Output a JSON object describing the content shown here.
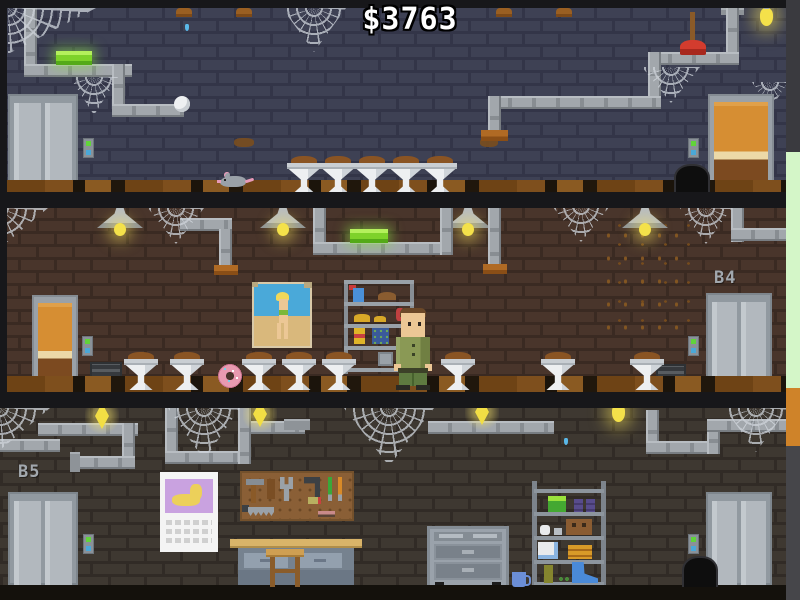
{
  "hud": {
    "money": "$3763"
  },
  "floors": [
    {
      "name": "basement-top-floor",
      "label": "",
      "objects": [
        "elevator-gray-left",
        "wooden-door-right",
        "call-buttons",
        "spider-webs",
        "pipes",
        "green-fluorescent-lamp",
        "hanging-bulb",
        "plunger-on-pipe",
        "spider-egg",
        "leaking-pipe-caps",
        "water-drip",
        "firefly",
        "rat",
        "dirty-sinks",
        "wall-stains",
        "mouse-hole"
      ]
    },
    {
      "name": "basement-floor-b4",
      "label": "B4",
      "objects": [
        "wooden-door-left",
        "elevator-gray-right",
        "call-buttons",
        "ceiling-lamps",
        "pipes",
        "green-fluorescent-lamp",
        "spider-webs",
        "fly-swarm",
        "pinup-poster",
        "supply-shelf",
        "janitor-character",
        "air-vents",
        "dirty-sinks",
        "donut"
      ]
    },
    {
      "name": "basement-floor-b5",
      "label": "B5",
      "objects": [
        "elevator-gray-left",
        "elevator-gray-right",
        "call-buttons",
        "pipes",
        "flame-lights",
        "hanging-bulb",
        "spider-webs",
        "calendar",
        "pegboard-with-tools",
        "workbench",
        "stool",
        "tool-cabinet",
        "mug",
        "storage-shelf",
        "trash-hole",
        "water-drip"
      ]
    }
  ],
  "colors": {
    "money_text": "#ffffff",
    "wall_top_floor": "#3e4154",
    "wall_middle_floor": "#49352b",
    "wall_bottom_floor": "#3e3831",
    "green_lamp": "#7ed22a",
    "elevator_doors": "#b2b8be",
    "wooden_door": "#d68e33",
    "call_button_green": "#61d33a",
    "call_button_blue": "#4aa8d8",
    "edge_strip_green": "#d4f6c8",
    "edge_strip_orange": "#cf8329"
  },
  "repeated": [
    {
      "type": "sink",
      "x": 287,
      "y": 156
    },
    {
      "type": "sink",
      "x": 321,
      "y": 156
    },
    {
      "type": "sink",
      "x": 355,
      "y": 156
    },
    {
      "type": "sink",
      "x": 389,
      "y": 156
    },
    {
      "type": "sink",
      "x": 423,
      "y": 156
    },
    {
      "type": "sink",
      "x": 124,
      "y": 352
    },
    {
      "type": "sink",
      "x": 170,
      "y": 352
    },
    {
      "type": "sink",
      "x": 242,
      "y": 352
    },
    {
      "type": "sink",
      "x": 282,
      "y": 352
    },
    {
      "type": "sink",
      "x": 322,
      "y": 352
    },
    {
      "type": "sink",
      "x": 441,
      "y": 352
    },
    {
      "type": "sink",
      "x": 541,
      "y": 352
    },
    {
      "type": "sink",
      "x": 630,
      "y": 352
    },
    {
      "type": "cap",
      "x": 176,
      "y": 8
    },
    {
      "type": "cap",
      "x": 236,
      "y": 8
    },
    {
      "type": "cap",
      "x": 496,
      "y": 8
    },
    {
      "type": "cap",
      "x": 556,
      "y": 8
    },
    {
      "type": "flame",
      "x": 85,
      "y": 396
    },
    {
      "type": "flame",
      "x": 243,
      "y": 394
    },
    {
      "type": "flame",
      "x": 465,
      "y": 392
    },
    {
      "type": "stain",
      "x": 234,
      "y": 138,
      "w": 20,
      "h": 9
    },
    {
      "type": "stain",
      "x": 480,
      "y": 138,
      "w": 18,
      "h": 9
    },
    {
      "type": "drip",
      "x": 185,
      "y": 24
    },
    {
      "type": "drip",
      "x": 564,
      "y": 438
    },
    {
      "type": "ffly",
      "x": 392,
      "y": 15
    }
  ]
}
